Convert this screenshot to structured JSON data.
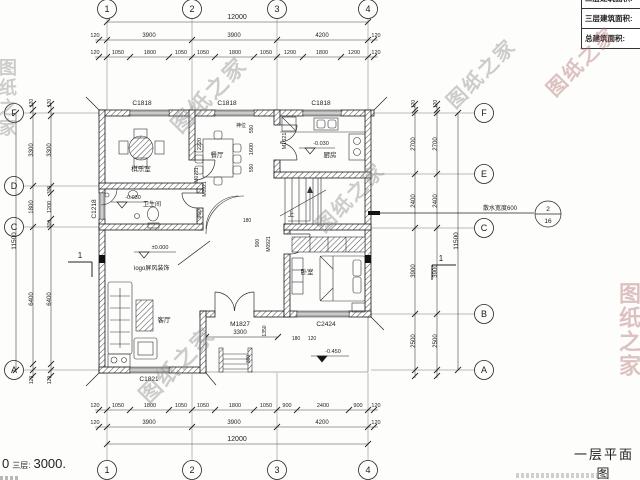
{
  "title_block": {
    "title": "一层平面图"
  },
  "area_table": {
    "rows": [
      "二层建筑面积:",
      "三层建筑面积:",
      "总建筑面积:"
    ]
  },
  "floor_note": {
    "t1": "0",
    "t2": "三层:",
    "t3": "3000."
  },
  "watermark": {
    "text": "图纸之家",
    "color": "#8a8a8a",
    "accent_color": "#b07070",
    "instances": [
      {
        "x": 160,
        "y": 78,
        "rot": -45,
        "fs": 22
      },
      {
        "x": 436,
        "y": 58,
        "rot": -45,
        "fs": 20
      },
      {
        "x": 536,
        "y": 46,
        "rot": -45,
        "fs": 20,
        "accent": 1
      },
      {
        "x": 305,
        "y": 182,
        "rot": -45,
        "fs": 20
      },
      {
        "x": 128,
        "y": 348,
        "rot": -45,
        "fs": 22
      },
      {
        "x": 612,
        "y": 282,
        "vert": 1,
        "fs": 22,
        "accent": 1
      },
      {
        "x": -6,
        "y": 58,
        "vert": 1,
        "fs": 18
      }
    ]
  },
  "grid": {
    "top": [
      {
        "label": "1",
        "x": 107
      },
      {
        "label": "2",
        "x": 192
      },
      {
        "label": "3",
        "x": 277
      },
      {
        "label": "4",
        "x": 368
      }
    ],
    "bottom": [
      {
        "label": "1",
        "x": 107
      },
      {
        "label": "2",
        "x": 192
      },
      {
        "label": "3",
        "x": 277
      },
      {
        "label": "4",
        "x": 368
      }
    ],
    "left": [
      {
        "label": "F",
        "y": 113
      },
      {
        "label": "D",
        "y": 186
      },
      {
        "label": "C",
        "y": 227
      },
      {
        "label": "A",
        "y": 370
      }
    ],
    "right": [
      {
        "label": "F",
        "y": 113
      },
      {
        "label": "E",
        "y": 174
      },
      {
        "label": "C",
        "y": 228
      },
      {
        "label": "B",
        "y": 314
      },
      {
        "label": "A",
        "y": 370
      }
    ]
  },
  "dims": {
    "h": [
      {
        "t": "12000",
        "x": 237,
        "y": 19,
        "fs": 7
      },
      {
        "t": "3900",
        "x": 149,
        "y": 37
      },
      {
        "t": "3900",
        "x": 234,
        "y": 37
      },
      {
        "t": "4200",
        "x": 322,
        "y": 37
      },
      {
        "t": "120",
        "x": 95,
        "y": 37,
        "fs": 5.5
      },
      {
        "t": "120",
        "x": 376,
        "y": 37,
        "fs": 5.5
      },
      {
        "t": "1050",
        "x": 118,
        "y": 54,
        "fs": 5.5
      },
      {
        "t": "1800",
        "x": 150,
        "y": 54,
        "fs": 5.5
      },
      {
        "t": "1050",
        "x": 181,
        "y": 54,
        "fs": 5.5
      },
      {
        "t": "1050",
        "x": 203,
        "y": 54,
        "fs": 5.5
      },
      {
        "t": "1800",
        "x": 235,
        "y": 54,
        "fs": 5.5
      },
      {
        "t": "1050",
        "x": 266,
        "y": 54,
        "fs": 5.5
      },
      {
        "t": "1200",
        "x": 290,
        "y": 54,
        "fs": 5.5
      },
      {
        "t": "1800",
        "x": 322,
        "y": 54,
        "fs": 5.5
      },
      {
        "t": "1200",
        "x": 354,
        "y": 54,
        "fs": 5.5
      },
      {
        "t": "120",
        "x": 95,
        "y": 54,
        "fs": 5.5
      },
      {
        "t": "120",
        "x": 376,
        "y": 54,
        "fs": 5.5
      },
      {
        "t": "1050",
        "x": 118,
        "y": 407,
        "fs": 5.5
      },
      {
        "t": "1800",
        "x": 150,
        "y": 407,
        "fs": 5.5
      },
      {
        "t": "1050",
        "x": 181,
        "y": 407,
        "fs": 5.5
      },
      {
        "t": "1050",
        "x": 203,
        "y": 407,
        "fs": 5.5
      },
      {
        "t": "1800",
        "x": 235,
        "y": 407,
        "fs": 5.5
      },
      {
        "t": "1050",
        "x": 266,
        "y": 407,
        "fs": 5.5
      },
      {
        "t": "900",
        "x": 287,
        "y": 407,
        "fs": 5.5
      },
      {
        "t": "2400",
        "x": 323,
        "y": 407,
        "fs": 5.5
      },
      {
        "t": "900",
        "x": 358,
        "y": 407,
        "fs": 5.5
      },
      {
        "t": "120",
        "x": 95,
        "y": 407,
        "fs": 5.5
      },
      {
        "t": "120",
        "x": 376,
        "y": 407,
        "fs": 5.5
      },
      {
        "t": "3900",
        "x": 149,
        "y": 424
      },
      {
        "t": "3900",
        "x": 234,
        "y": 424
      },
      {
        "t": "4200",
        "x": 322,
        "y": 424
      },
      {
        "t": "120",
        "x": 95,
        "y": 424,
        "fs": 5.5
      },
      {
        "t": "120",
        "x": 376,
        "y": 424,
        "fs": 5.5
      },
      {
        "t": "12000",
        "x": 237,
        "y": 441,
        "fs": 7
      },
      {
        "t": "3300",
        "x": 240,
        "y": 334,
        "fs": 6
      },
      {
        "t": "180",
        "x": 247,
        "y": 222,
        "fs": 5
      },
      {
        "t": "180",
        "x": 296,
        "y": 340,
        "fs": 5
      },
      {
        "t": "120",
        "x": 312,
        "y": 340,
        "fs": 5
      }
    ],
    "v": [
      {
        "t": "3300",
        "x": 33,
        "y": 150
      },
      {
        "t": "1800",
        "x": 33,
        "y": 207
      },
      {
        "t": "6400",
        "x": 33,
        "y": 299
      },
      {
        "t": "3300",
        "x": 51,
        "y": 150
      },
      {
        "t": "300",
        "x": 51,
        "y": 190,
        "fs": 5
      },
      {
        "t": "1200",
        "x": 51,
        "y": 207,
        "fs": 5.5
      },
      {
        "t": "300",
        "x": 51,
        "y": 224,
        "fs": 5
      },
      {
        "t": "6400",
        "x": 51,
        "y": 299
      },
      {
        "t": "11500",
        "x": 16,
        "y": 241,
        "fs": 6.5
      },
      {
        "t": "120",
        "x": 33,
        "y": 103,
        "fs": 5
      },
      {
        "t": "120",
        "x": 51,
        "y": 103,
        "fs": 5
      },
      {
        "t": "120",
        "x": 33,
        "y": 380,
        "fs": 5
      },
      {
        "t": "120",
        "x": 51,
        "y": 380,
        "fs": 5
      },
      {
        "t": "2700",
        "x": 415,
        "y": 144
      },
      {
        "t": "2400",
        "x": 415,
        "y": 201
      },
      {
        "t": "3900",
        "x": 415,
        "y": 271
      },
      {
        "t": "2500",
        "x": 415,
        "y": 341
      },
      {
        "t": "2700",
        "x": 437,
        "y": 144
      },
      {
        "t": "2400",
        "x": 437,
        "y": 201
      },
      {
        "t": "3900",
        "x": 437,
        "y": 271
      },
      {
        "t": "2500",
        "x": 437,
        "y": 341
      },
      {
        "t": "11500",
        "x": 458,
        "y": 241,
        "fs": 6.5
      },
      {
        "t": "120",
        "x": 415,
        "y": 104,
        "fs": 5
      },
      {
        "t": "120",
        "x": 437,
        "y": 104,
        "fs": 5
      },
      {
        "t": "2220",
        "x": 201,
        "y": 144,
        "fs": 5.5
      },
      {
        "t": "550",
        "x": 253,
        "y": 129,
        "fs": 5
      },
      {
        "t": "1600",
        "x": 253,
        "y": 149,
        "fs": 5.5
      },
      {
        "t": "550",
        "x": 253,
        "y": 168,
        "fs": 5
      },
      {
        "t": "900",
        "x": 201,
        "y": 214,
        "fs": 5.5
      },
      {
        "t": "900",
        "x": 259,
        "y": 243,
        "fs": 5
      },
      {
        "t": "1350",
        "x": 266,
        "y": 331,
        "fs": 5
      },
      {
        "t": "300",
        "x": 250,
        "y": 359,
        "fs": 5
      }
    ]
  },
  "openings": [
    {
      "t": "C1818",
      "x": 142,
      "y": 105
    },
    {
      "t": "C1818",
      "x": 227,
      "y": 105
    },
    {
      "t": "C1818",
      "x": 321,
      "y": 105
    },
    {
      "t": "C1218",
      "x": 96,
      "y": 209,
      "rot": 1
    },
    {
      "t": "M1621",
      "x": 286,
      "y": 141,
      "rot": 1,
      "fs": 5.5
    },
    {
      "t": "M0721",
      "x": 198,
      "y": 175,
      "rot": 1,
      "fs": 5
    },
    {
      "t": "M0921",
      "x": 206,
      "y": 189,
      "rot": 1,
      "fs": 5
    },
    {
      "t": "M0921",
      "x": 270,
      "y": 244,
      "rot": 1,
      "fs": 5
    },
    {
      "t": "M1827",
      "x": 240,
      "y": 326,
      "fs": 6.5
    },
    {
      "t": "C2424",
      "x": 326,
      "y": 326,
      "fs": 6.5
    },
    {
      "t": "C1821",
      "x": 149,
      "y": 381,
      "fs": 6.5
    }
  ],
  "rooms": [
    {
      "t": "棋乐室",
      "x": 141,
      "y": 171,
      "fs": 6.5
    },
    {
      "t": "餐厅",
      "x": 217,
      "y": 157,
      "fs": 6.5
    },
    {
      "t": "厨房",
      "x": 330,
      "y": 157,
      "fs": 6.5
    },
    {
      "t": "卫生间",
      "x": 152,
      "y": 206,
      "fs": 6
    },
    {
      "t": "客厅",
      "x": 164,
      "y": 322,
      "fs": 6.5
    },
    {
      "t": "卧室",
      "x": 307,
      "y": 274,
      "fs": 6.5
    },
    {
      "t": "神位",
      "x": 241,
      "y": 127,
      "fs": 5
    },
    {
      "t": "上",
      "x": 291,
      "y": 216,
      "fs": 6.5
    }
  ],
  "elevations": [
    {
      "t": "±0.000",
      "x": 160,
      "y": 249,
      "lx1": 134,
      "lx2": 176,
      "ly": 252,
      "tx": 144,
      "filled": false
    },
    {
      "t": "-0.030",
      "x": 133,
      "y": 199,
      "lx1": 111,
      "lx2": 147,
      "ly": 202,
      "tx": 122,
      "filled": false
    },
    {
      "t": "-0.030",
      "x": 321,
      "y": 145,
      "lx1": 299,
      "lx2": 335,
      "ly": 148,
      "tx": 310,
      "filled": false
    },
    {
      "t": "-0.450",
      "x": 333,
      "y": 353,
      "lx1": 311,
      "lx2": 349,
      "ly": 356,
      "tx": 322,
      "filled": true
    }
  ],
  "annotations": {
    "apron": {
      "label": "散水宽度600",
      "x": 500,
      "y": 210,
      "num": "2",
      "den": "16",
      "cx": 548,
      "cy": 214
    },
    "sections": [
      {
        "t": "1",
        "x": 80,
        "y": 258
      },
      {
        "t": "1",
        "x": 441,
        "y": 261
      }
    ],
    "screen_label": {
      "t": "logo屏风装饰",
      "x": 134,
      "y": 270
    }
  }
}
